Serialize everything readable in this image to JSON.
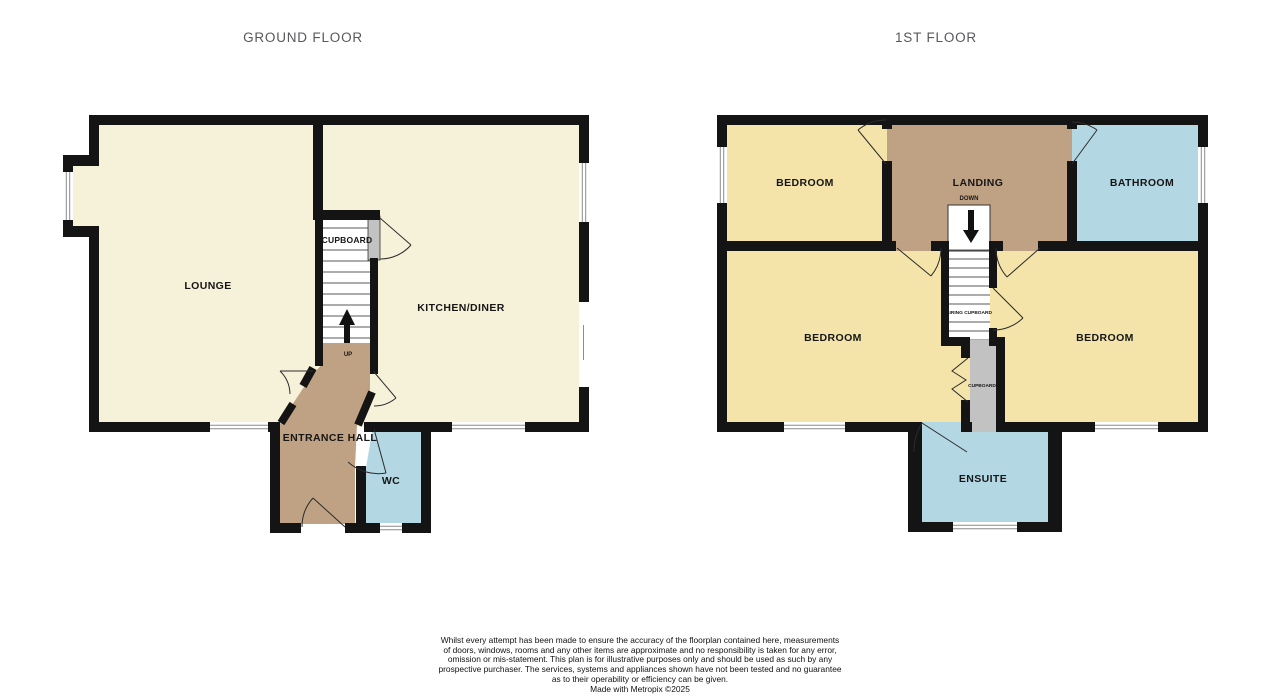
{
  "titles": {
    "ground": "GROUND FLOOR",
    "first": "1ST FLOOR"
  },
  "ground_floor": {
    "lounge": "LOUNGE",
    "cupboard": "CUPBOARD",
    "kitchen_diner": "KITCHEN/DINER",
    "entrance_hall": "ENTRANCE HALL",
    "wc": "WC",
    "stairs_direction": "UP"
  },
  "first_floor": {
    "bedroom_top": "BEDROOM",
    "landing": "LANDING",
    "stairs_direction": "DOWN",
    "bathroom": "BATHROOM",
    "bedroom_left": "BEDROOM",
    "bedroom_right": "BEDROOM",
    "airing_cupboard": "AIRING CUPBOARD",
    "cupboard": "CUPBOARD",
    "ensuite": "ENSUITE"
  },
  "footer": {
    "lines": [
      "Whilst every attempt has been made to ensure the accuracy of the floorplan contained here, measurements",
      "of doors, windows, rooms and any other items are approximate and no responsibility is taken for any error,",
      "omission or mis-statement. This plan is for illustrative purposes only and should be used as such by any",
      "prospective purchaser. The services, systems and appliances shown have not been tested and no guarantee",
      "as to their operability or efficiency can be given."
    ],
    "credit": "Made with Metropix ©2025"
  },
  "colors": {
    "wall": "#141414",
    "cream": "#f6f1d9",
    "yellow": "#f4e4aa",
    "tan": "#bfa284",
    "blue": "#b3d7e3",
    "gray": "#c2c2c2"
  }
}
